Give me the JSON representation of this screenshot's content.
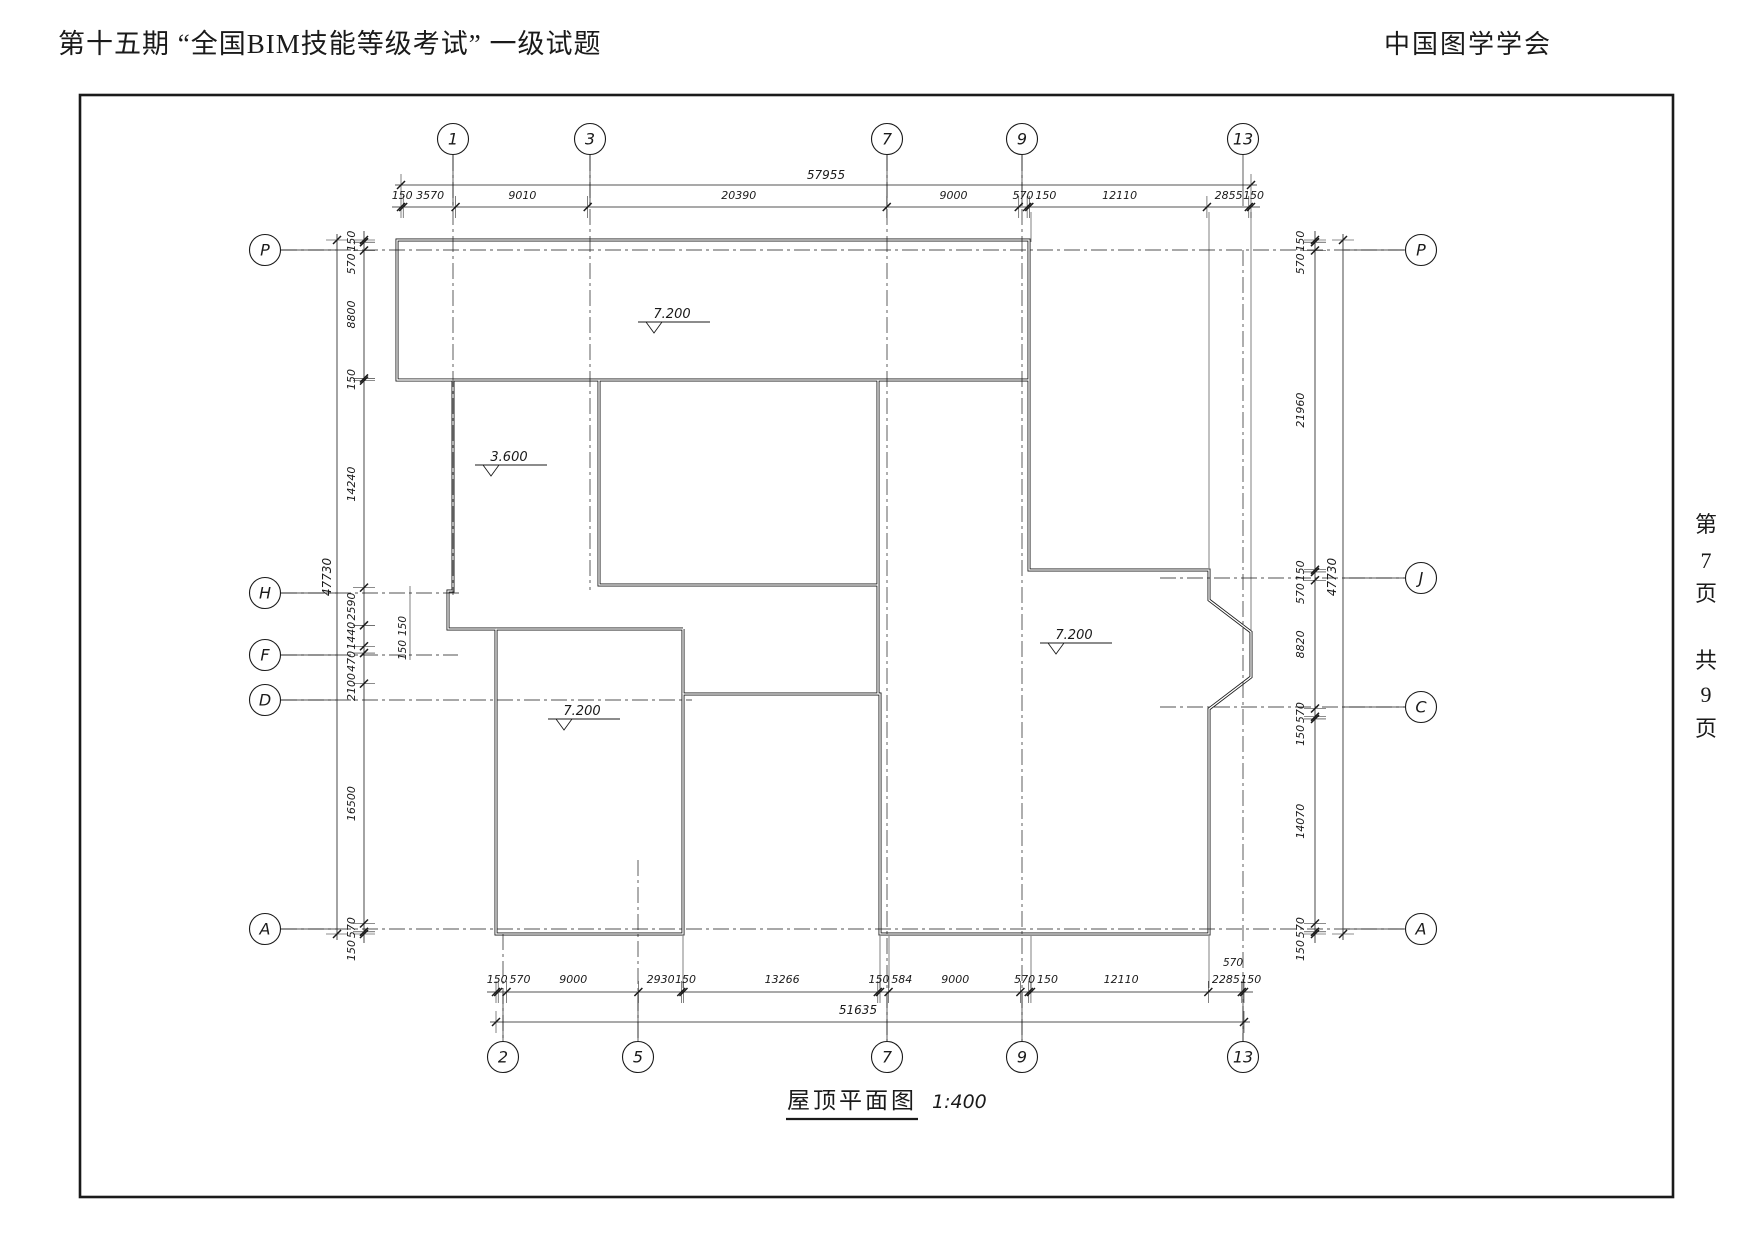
{
  "header": {
    "left": "第十五期 “全国BIM技能等级考试” 一级试题",
    "right": "中国图学学会"
  },
  "page_note": {
    "chars": [
      "第",
      "7",
      "页",
      "共",
      "9",
      "页"
    ]
  },
  "title": {
    "name": "屋顶平面图",
    "scale": "1:400"
  },
  "grids": {
    "top": [
      "1",
      "3",
      "7",
      "9",
      "13"
    ],
    "bottom": [
      "2",
      "5",
      "7",
      "9",
      "13"
    ],
    "left": [
      "P",
      "H",
      "F",
      "D",
      "A"
    ],
    "right": [
      "P",
      "J",
      "C",
      "A"
    ]
  },
  "dimensions": {
    "top": {
      "total": "57955",
      "segments": [
        "150",
        "3570",
        "9010",
        "20390",
        "9000",
        "570",
        "150",
        "12110",
        "2855",
        "150"
      ]
    },
    "bottom": {
      "total": "51635",
      "segments": [
        "150",
        "570",
        "9000",
        "2930",
        "150",
        "13266",
        "150",
        "584",
        "9000",
        "570",
        "150",
        "12110",
        "2285",
        "150"
      ],
      "extra": "570"
    },
    "left": {
      "total": "47730",
      "segments": [
        "150",
        "570",
        "8800",
        "150",
        "14240",
        "2590",
        "1440",
        "470",
        "2100",
        "16500",
        "570",
        "150"
      ],
      "extra": [
        "150",
        "150"
      ]
    },
    "right": {
      "total": "47730",
      "segments": [
        "150",
        "570",
        "21960",
        "150",
        "570",
        "8820",
        "570",
        "150",
        "14070",
        "570",
        "150"
      ]
    }
  },
  "elevations": [
    {
      "value": "7.200",
      "location": "top-bar"
    },
    {
      "value": "3.600",
      "location": "left-middle"
    },
    {
      "value": "7.200",
      "location": "lower-left"
    },
    {
      "value": "7.200",
      "location": "right-wing"
    }
  ],
  "colors": {
    "line": "#1a1a1a",
    "background": "#ffffff"
  }
}
